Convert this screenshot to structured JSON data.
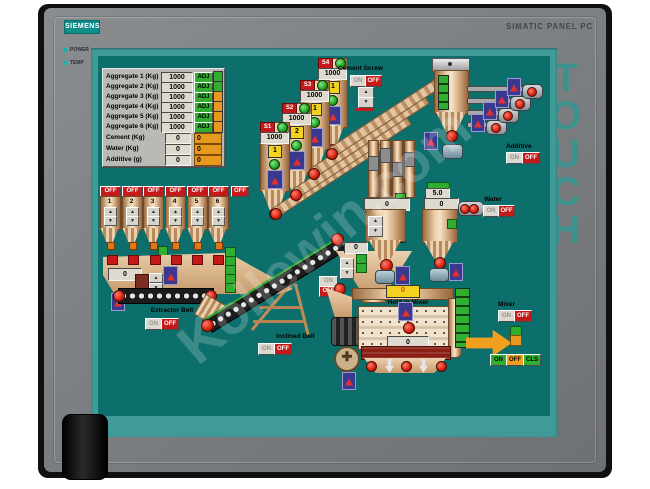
{
  "device": {
    "brand": "SIEMENS",
    "model": "SIMATIC PANEL PC",
    "touch_label": "TOUCH",
    "power_label": "POWER",
    "temp_label": "TEMP"
  },
  "colors": {
    "screen_bg": "#0c6f6c",
    "screen_frame": "#3f9b97",
    "bezel_grey": "#7a7d80",
    "status_green": "#2fae2f",
    "status_orange": "#e8981c",
    "off_red": "#c41a1a",
    "led_teal": "#17b3a8"
  },
  "watermark": "Kollewin.com",
  "params": {
    "rows": [
      {
        "label": "Aggregate 1 (Kg)",
        "value": "1000",
        "adj": "ADJ",
        "status_color": "#2fae2f"
      },
      {
        "label": "Aggregate 2 (Kg)",
        "value": "1000",
        "adj": "ADJ",
        "status_color": "#2fae2f"
      },
      {
        "label": "Aggregate 3 (Kg)",
        "value": "1000",
        "adj": "ADJ",
        "status_color": "#e8981c"
      },
      {
        "label": "Aggregate 4 (Kg)",
        "value": "1000",
        "adj": "ADJ",
        "status_color": "#e8981c"
      },
      {
        "label": "Aggregate 5 (Kg)",
        "value": "1000",
        "adj": "ADJ",
        "status_color": "#e8981c"
      },
      {
        "label": "Aggregate 6 (Kg)",
        "value": "1000",
        "adj": "ADJ",
        "status_color": "#e8981c"
      },
      {
        "label": "Cement (Kg)",
        "value": "0",
        "aux": "0"
      },
      {
        "label": "Water (Kg)",
        "value": "0",
        "aux": "0"
      },
      {
        "label": "Additive (g)",
        "value": "0",
        "aux": "0"
      }
    ]
  },
  "hoppers": {
    "off_label": "OFF",
    "extra_off_label": "OFF",
    "items": [
      {
        "n": "1"
      },
      {
        "n": "2"
      },
      {
        "n": "3"
      },
      {
        "n": "4"
      },
      {
        "n": "5"
      },
      {
        "n": "6"
      }
    ]
  },
  "weigh_hopper": {
    "value": "0"
  },
  "extractor_belt": {
    "label": "Extractor Belt",
    "on": "ON",
    "off": "OFF"
  },
  "inclined_belt": {
    "label": "Inclined Belt",
    "on": "ON",
    "off": "OFF"
  },
  "transfer_hopper": {
    "value": "0",
    "on": "ON",
    "off": "OFF"
  },
  "cement_screw": {
    "label": "Cement Screw",
    "on": "ON",
    "off": "OFF"
  },
  "silos": [
    {
      "id": "S1",
      "value": "1000",
      "badge": "1"
    },
    {
      "id": "S2",
      "value": "1000",
      "badge": "2"
    },
    {
      "id": "S3",
      "value": "1000",
      "badge": "1"
    },
    {
      "id": "S4",
      "value": "1000",
      "badge": "1"
    }
  ],
  "cement_hopper": {
    "value": "0"
  },
  "water": {
    "label": "Water",
    "setpoint": "5.0",
    "value": "0",
    "on": "ON",
    "off": "OFF"
  },
  "additive": {
    "label": "Additive",
    "on": "ON",
    "off": "OFF"
  },
  "mixer": {
    "hold_label": "Hold in Mixer",
    "top_value": "0",
    "value": "0",
    "label": "Mixer",
    "on": "ON",
    "off": "OFF",
    "bottom_on": "ON",
    "bottom_off": "OFF",
    "bottom_cls": "CLS"
  }
}
